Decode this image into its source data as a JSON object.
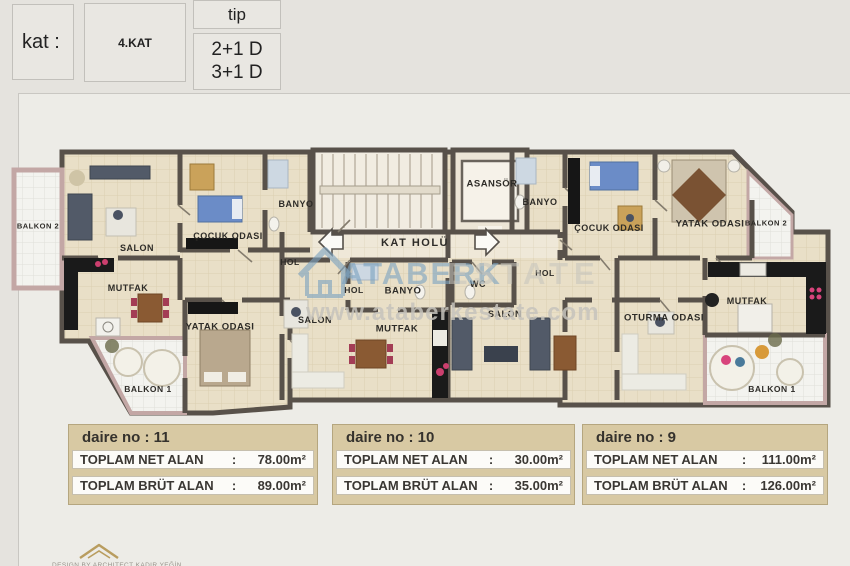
{
  "header": {
    "kat_label": "kat :",
    "kat_value": "4.KAT",
    "tip_label": "tip",
    "tip_value_line1": "2+1 D",
    "tip_value_line2": "3+1 D"
  },
  "plan": {
    "labels": [
      {
        "text": "BALKON 2"
      },
      {
        "text": "SALON"
      },
      {
        "text": "ÇOCUK ODASI"
      },
      {
        "text": "BANYO"
      },
      {
        "text": "HOL"
      },
      {
        "text": "MUTFAK"
      },
      {
        "text": "YATAK ODASI"
      },
      {
        "text": "BALKON 1"
      },
      {
        "text": "KAT HOLÜ"
      },
      {
        "text": "ASANSÖR"
      },
      {
        "text": "HOL"
      },
      {
        "text": "BANYO"
      },
      {
        "text": "WC"
      },
      {
        "text": "SALON"
      },
      {
        "text": "MUTFAK"
      },
      {
        "text": "BANYO"
      },
      {
        "text": "ÇOCUK ODASI"
      },
      {
        "text": "YATAK ODASI"
      },
      {
        "text": "BALKON 2"
      },
      {
        "text": "HOL"
      },
      {
        "text": "SALON"
      },
      {
        "text": "OTURMA ODASI"
      },
      {
        "text": "MUTFAK"
      },
      {
        "text": "BALKON 1"
      }
    ]
  },
  "watermark": {
    "brand": "ATABERK",
    "brand2": "ESTATE",
    "url": "www.ataberkestate.com"
  },
  "apartments": [
    {
      "title": "daire no : 11",
      "net_label": "TOPLAM NET ALAN",
      "net_value": "78.00m²",
      "brut_label": "TOPLAM BRÜT ALAN",
      "brut_value": "89.00m²"
    },
    {
      "title": "daire no : 10",
      "net_label": "TOPLAM NET ALAN",
      "net_value": "30.00m²",
      "brut_label": "TOPLAM BRÜT ALAN",
      "brut_value": "35.00m²"
    },
    {
      "title": "daire no : 9",
      "net_label": "TOPLAM NET ALAN",
      "net_value": "111.00m²",
      "brut_label": "TOPLAM BRÜT ALAN",
      "brut_value": "126.00m²"
    }
  ],
  "footer": {
    "credit": "DESIGN BY ARCHITECT KADIR YEĞİN"
  },
  "misc": {
    "colon": ":"
  },
  "colors": {
    "wall": "#58514a",
    "floor": "#e9dfc7",
    "hall_floor": "#efe8d8",
    "balcony_wall": "#c3a7a5",
    "kitchen_counter": "#1a1a1a",
    "watermark_blue": "#7da3c0",
    "info_box_tan": "#d8c9a3",
    "bed_blue": "#6b8cc7",
    "accent_pink": "#d8447c"
  }
}
